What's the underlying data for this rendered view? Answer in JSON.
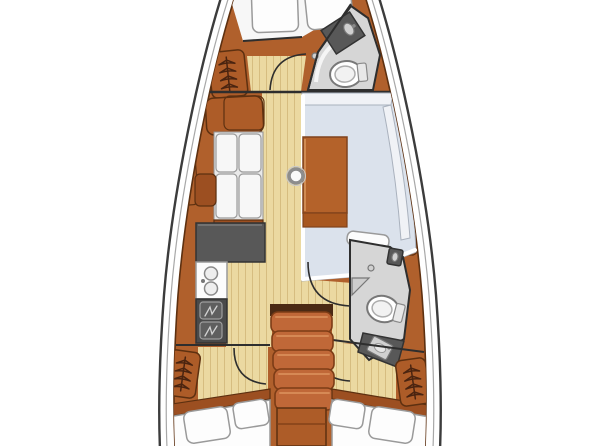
{
  "page": {
    "background": "#ffffff"
  },
  "colors": {
    "hull_fill": "#ffffff",
    "hull_line": "#3c3c3c",
    "deck_line": "#a8a8a8",
    "wood": "#b0602c",
    "wood_dark": "#9c4f21",
    "wood_panel": "#ad5c28",
    "wood_edge": "#5d3010",
    "floor": "#ebd9a1",
    "floor_line": "#d6bd80",
    "cushion": "#f7f7f7",
    "cushion_line": "#9a9a9a",
    "dinette": "#dbe2ec",
    "dinette_line": "#a9b1bd",
    "backrest": "#f0f2f6",
    "head_floor": "#d6d6d6",
    "wall_line": "#2e2e2e",
    "counter": "#585858",
    "counter_dark": "#4a4a4a",
    "stair": "#c06838",
    "stair_edge": "#7c3c16",
    "stair_highlight": "#d98f5a",
    "table": "#b4622a",
    "table_edge": "#80431c",
    "table_highlight": "#d08b52",
    "symbol": "#4a2410",
    "highlight": "#ffffff"
  },
  "fixtures": {
    "bow_cabin": [
      "v-berth-double",
      "pillow-left",
      "pillow-right",
      "hanging-locker",
      "seat"
    ],
    "forward_head": [
      "vanity-sink",
      "toilet",
      "drain",
      "door-swing"
    ],
    "salon": [
      "port-settee-4-cushions",
      "side-shelf",
      "salon-table",
      "mast-post",
      "u-shaped-dinette"
    ],
    "galley": [
      "l-shaped-counter",
      "double-sink",
      "two-burner-stove"
    ],
    "companionway": [
      "stairs-5-steps",
      "engine-box"
    ],
    "aft_head": [
      "hand-sink",
      "drain",
      "shower-seat",
      "toilet",
      "vanity-sink",
      "door-swing"
    ],
    "aft_cabin_port": [
      "hanging-locker",
      "double-berth",
      "pillow-large",
      "pillow-small",
      "door-swing"
    ],
    "aft_cabin_starboard": [
      "hanging-locker",
      "double-berth",
      "pillow-small",
      "pillow-large",
      "door-swing"
    ]
  }
}
